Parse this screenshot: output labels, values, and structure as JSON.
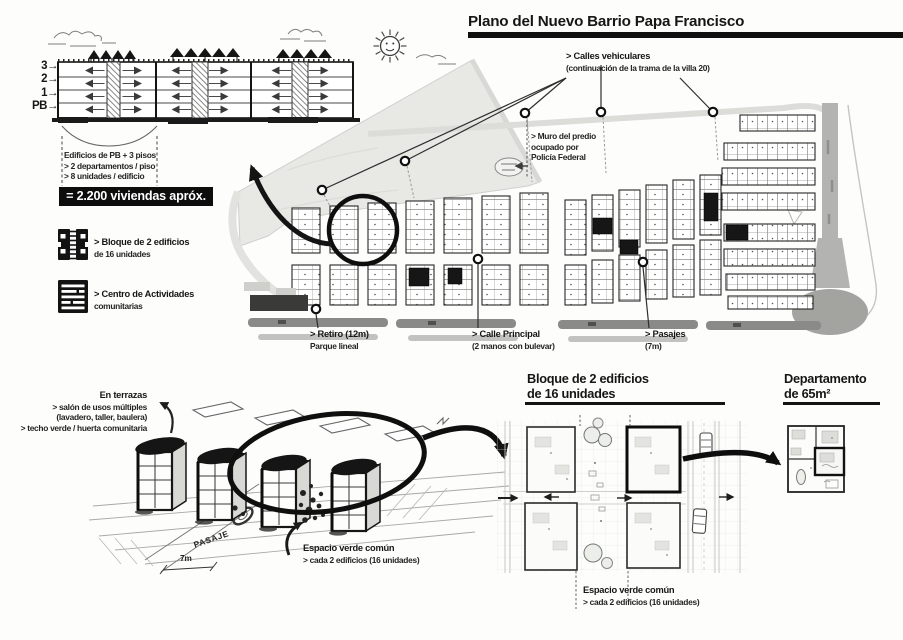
{
  "header": {
    "title": "Plano del Nuevo Barrio Papa Francisco"
  },
  "section_diagram": {
    "floor_labels": [
      "3→",
      "2→",
      "1→",
      "PB→"
    ],
    "notes": {
      "line1": "Edificios de PB + 3 pisos",
      "line2": "> 2 departamentos / piso",
      "line3": "> 8 unidades / edificio"
    },
    "total_banner": "= 2.200 viviendas apróx."
  },
  "legend": {
    "items": [
      {
        "icon": "block-of-2-buildings-icon",
        "line1": "> Bloque de 2 edificios",
        "line2": "de 16 unidades"
      },
      {
        "icon": "community-activities-center-icon",
        "line1": "> Centro de Actividades",
        "line2": "comunitarias"
      }
    ]
  },
  "map": {
    "callout_calles": {
      "line1": "> Calles vehiculares",
      "line2": "(continuación de la trama de la villa 20)"
    },
    "callout_muro": {
      "line1": "> Muro del predio",
      "line2": "ocupado por",
      "line3": "Policía Federal"
    },
    "callout_retiro": {
      "line1": "> Retiro (12m)",
      "line2": "Parque lineal"
    },
    "callout_calle_principal": {
      "line1": "> Calle Principal",
      "line2": "(2 manos con bulevar)"
    },
    "callout_pasajes": {
      "line1": "> Pasajes",
      "line2": "(7m)"
    }
  },
  "axon_sketch": {
    "terraces_note": {
      "line1": "En terrazas",
      "line2": "> salón de usos múltiples",
      "line3": "(lavadero, taller, baulera)",
      "line4": "> techo verde / huerta comunitaria"
    },
    "pasaje_label": "PASAJE",
    "dimension_label": "7m",
    "green_space_note": {
      "line1": "Espacio verde común",
      "line2": "> cada 2 edificios (16 unidades)"
    }
  },
  "block_plan": {
    "heading": {
      "line1": "Bloque de 2 edificios",
      "line2": "de 16 unidades"
    },
    "green_space_note": {
      "line1": "Espacio verde común",
      "line2": "> cada 2 edificios (16 unidades)"
    }
  },
  "apartment_plan": {
    "heading": {
      "line1": "Departamento",
      "line2": "de 65m²"
    }
  }
}
